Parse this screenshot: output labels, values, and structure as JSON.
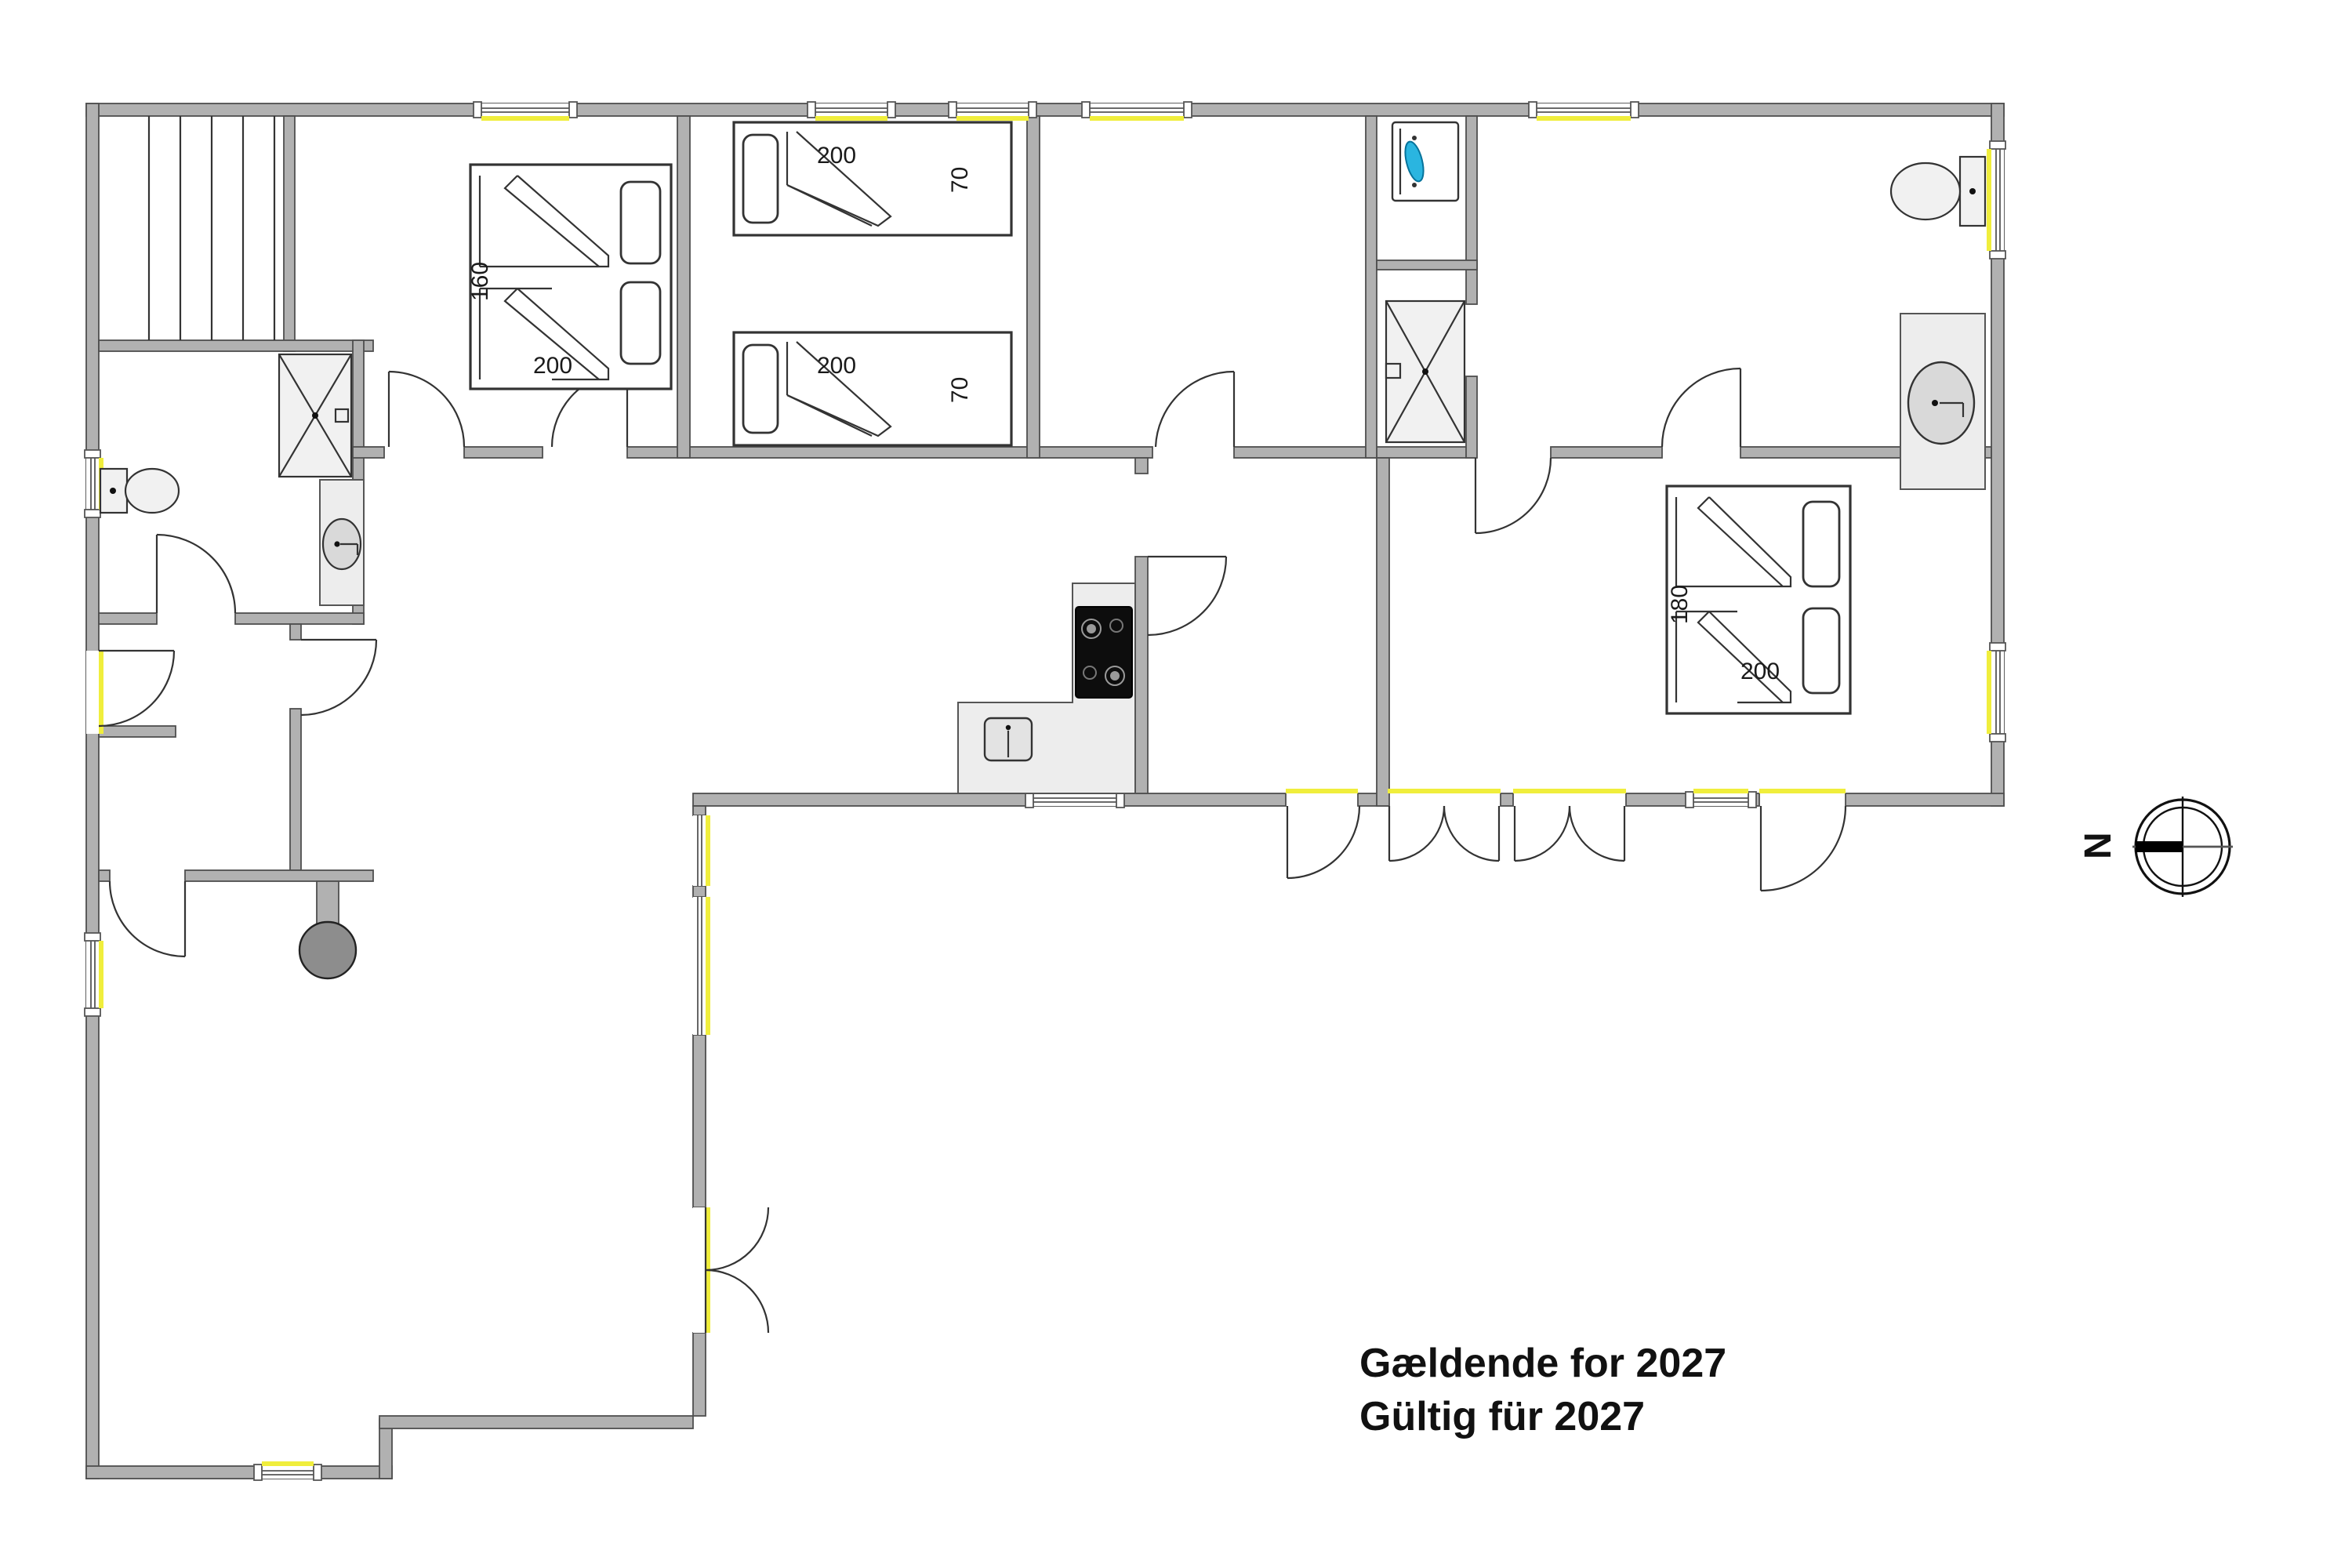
{
  "title": {
    "line1": "Gældende for 2027",
    "line2": "Gültig für 2027"
  },
  "compass": {
    "label": "N"
  },
  "beds": {
    "bedroom1_double": {
      "width": "160",
      "length": "200"
    },
    "bedroom2_single_top": {
      "length": "200",
      "width": "70"
    },
    "bedroom2_single_bottom": {
      "length": "200",
      "width": "70"
    },
    "bedroom4_double": {
      "width": "180",
      "length": "200"
    }
  },
  "icons": [
    "shower-icon",
    "toilet-icon",
    "sink-icon",
    "washing-machine-icon",
    "cooktop-icon",
    "kitchen-sink-icon",
    "wood-stove-icon",
    "sauna-bench-icon",
    "door-swing-icon",
    "window-icon",
    "compass-rose-icon"
  ],
  "colors": {
    "wall": "#b1b1b1",
    "wall_outline": "#4f4f4f",
    "opening_accent": "#f0ee3c",
    "fixture_fill": "#f1f1f1",
    "counter_fill": "#ededed",
    "cooktop": "#111111",
    "stove": "#8d8d8d",
    "appliance_accent": "#2ab5e0",
    "text": "#1a1a1a"
  }
}
